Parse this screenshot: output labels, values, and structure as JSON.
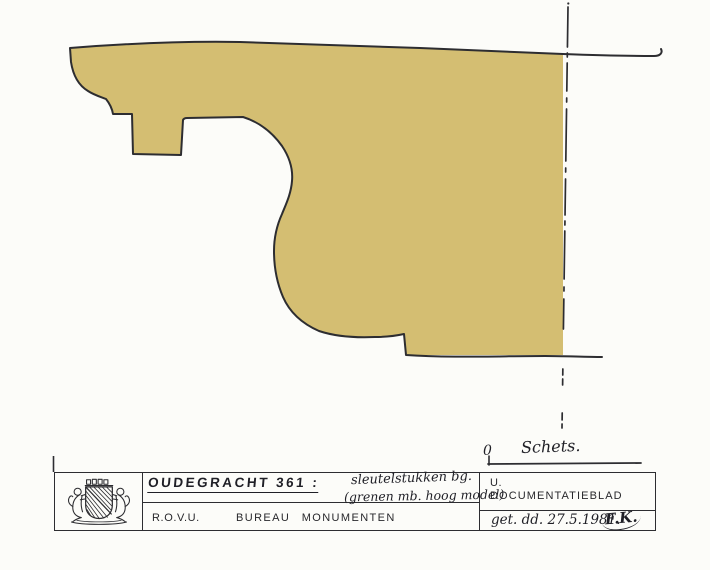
{
  "page": {
    "background": "#fcfcf9",
    "ink_color": "#2d2d31",
    "profile_fill_color": "#d4be72"
  },
  "drawing": {
    "scale_zero": "0",
    "scale_label": "Schets."
  },
  "title_block": {
    "logo_icon": "utrecht-coat-of-arms",
    "row1": {
      "title": "OUDEGRACHT 361 :",
      "subject_line1": "sleutelstukken bg.",
      "subject_line2": "(grenen mb. hoog model)",
      "org": "U.",
      "doc_type": "DOCUMENTATIEBLAD"
    },
    "row2": {
      "agency": "R.O.V.U.",
      "bureau": "BUREAU MONUMENTEN",
      "date": "get. dd. 27.5.1981.",
      "signature": "F.K."
    }
  }
}
